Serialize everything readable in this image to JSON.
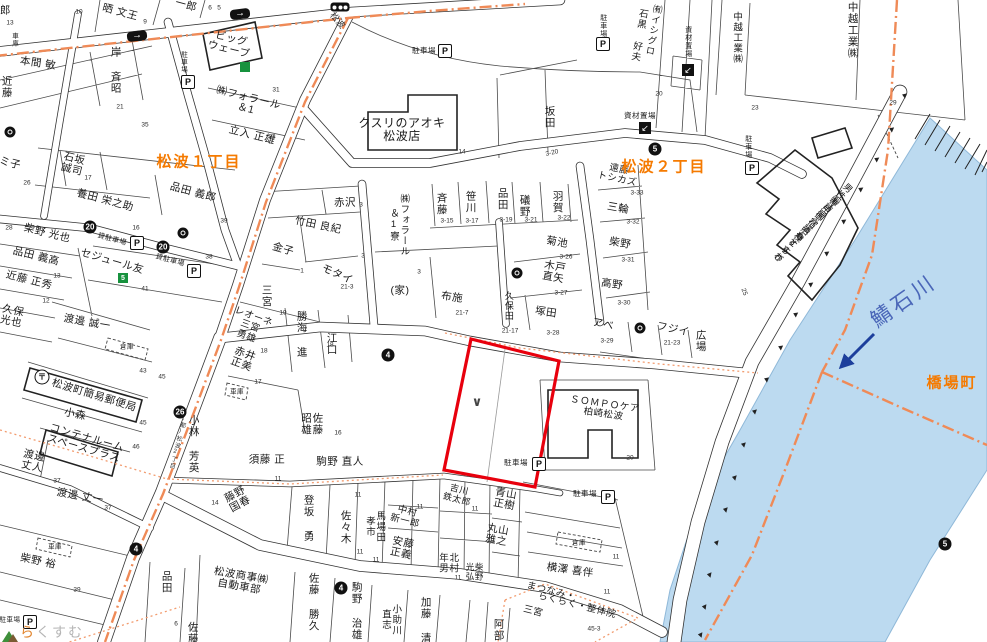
{
  "colors": {
    "boundary_orange": "#ef8a57",
    "river_fill": "#bcdaf0",
    "river_label_blue": "#4a66b8",
    "district_orange": "#f57a00",
    "highlight_red": "#e8000d",
    "flow_arrow_blue": "#1d3f9c"
  },
  "districts": [
    {
      "t": "松波１丁目",
      "x": 199,
      "y": 161
    },
    {
      "t": "松波２丁目",
      "x": 664,
      "y": 166
    },
    {
      "t": "橋場町",
      "x": 952,
      "y": 382
    }
  ],
  "river": {
    "name": "鯖石川",
    "x": 903,
    "y": 300
  },
  "road_names": [
    {
      "t": "松波",
      "x": 338,
      "y": 20,
      "r": 50,
      "s": 9
    },
    {
      "t": "(都)松波2丁目",
      "x": 177,
      "y": 442,
      "v": true,
      "r": 14,
      "s": 6
    }
  ],
  "watermark": {
    "t": "らくすむ",
    "x": 10,
    "y": 632
  },
  "highlight_parcel": {
    "mark": "∨",
    "x": 477,
    "y": 402
  },
  "labels": [
    {
      "t": "郎",
      "x": 4,
      "y": 10,
      "v": true
    },
    {
      "t": "晒 文王",
      "x": 120,
      "y": 13,
      "r": 15
    },
    {
      "t": "一郎",
      "x": 186,
      "y": 6,
      "r": 15
    },
    {
      "t": "本間 敏",
      "x": 38,
      "y": 64,
      "r": 8
    },
    {
      "t": "岸 斉昭",
      "x": 115,
      "y": 70,
      "v": true
    },
    {
      "t": "近藤",
      "x": 6,
      "y": 87,
      "v": true
    },
    {
      "t": "車庫",
      "x": 14,
      "y": 40,
      "v": true,
      "s": 6.5
    },
    {
      "t": "ビッグ\nウェーブ",
      "x": 230,
      "y": 45,
      "r": 14
    },
    {
      "t": "㈱フォラール\n＆1",
      "x": 247,
      "y": 104,
      "r": 14
    },
    {
      "t": "立入 正雄",
      "x": 252,
      "y": 136,
      "r": 14
    },
    {
      "t": "石坂\n誠司",
      "x": 73,
      "y": 165,
      "r": 14
    },
    {
      "t": "ミ子",
      "x": 10,
      "y": 164,
      "r": 14
    },
    {
      "t": "養田 栄之助",
      "x": 105,
      "y": 201,
      "r": 15
    },
    {
      "t": "品田 義郎",
      "x": 193,
      "y": 193,
      "r": 15
    },
    {
      "t": "柴野 光也",
      "x": 47,
      "y": 234,
      "r": 14
    },
    {
      "t": "品田 義高",
      "x": 36,
      "y": 257,
      "r": 14
    },
    {
      "t": "近藤 正秀",
      "x": 29,
      "y": 281,
      "r": 14
    },
    {
      "t": "セジュール友",
      "x": 112,
      "y": 262,
      "r": 16
    },
    {
      "t": "貸駐車場",
      "x": 112,
      "y": 240,
      "r": 15,
      "s": 7
    },
    {
      "t": "貸駐車場",
      "x": 170,
      "y": 261,
      "r": 15,
      "s": 7
    },
    {
      "t": "渡邊 誠一",
      "x": 87,
      "y": 323,
      "r": 10
    },
    {
      "t": "倉庫",
      "x": 127,
      "y": 347,
      "s": 6.5
    },
    {
      "t": "松波町簡易郵便局",
      "x": 94,
      "y": 396,
      "r": 17
    },
    {
      "t": "小森",
      "x": 75,
      "y": 415,
      "r": 12
    },
    {
      "t": "コンテナルーム\nスペースプラス",
      "x": 85,
      "y": 444,
      "r": 16
    },
    {
      "t": "渡邊\n丈人",
      "x": 33,
      "y": 462,
      "r": 12
    },
    {
      "t": "小林 芳英",
      "x": 193,
      "y": 444,
      "v": true
    },
    {
      "t": "赤井\n正美",
      "x": 243,
      "y": 360,
      "r": 20
    },
    {
      "t": "レオーネ\n三宮\n勇雄",
      "x": 250,
      "y": 327,
      "r": 20,
      "s": 9.5
    },
    {
      "t": "勝海 進",
      "x": 301,
      "y": 334,
      "v": true
    },
    {
      "t": "江口",
      "x": 331,
      "y": 344,
      "v": true
    },
    {
      "t": "佐藤\n昭雄",
      "x": 311,
      "y": 424,
      "v": true
    },
    {
      "t": "須藤 正",
      "x": 267,
      "y": 460
    },
    {
      "t": "駒野 直人",
      "x": 340,
      "y": 462
    },
    {
      "t": "車庫",
      "x": 237,
      "y": 392,
      "s": 6.5
    },
    {
      "t": "久保\n光也",
      "x": 12,
      "y": 317,
      "r": 12
    },
    {
      "t": "渡邊 丈一",
      "x": 80,
      "y": 497,
      "r": 10
    },
    {
      "t": "柴野 裕",
      "x": 38,
      "y": 562,
      "r": 12
    },
    {
      "t": "車庫",
      "x": 55,
      "y": 547,
      "s": 6.5
    },
    {
      "t": "品田",
      "x": 166,
      "y": 582,
      "v": true
    },
    {
      "t": "佐藤",
      "x": 192,
      "y": 633,
      "v": true
    },
    {
      "t": "藤野\n国春",
      "x": 238,
      "y": 500,
      "r": -28
    },
    {
      "t": "松波商事㈱\n自動車部",
      "x": 240,
      "y": 582,
      "r": 10
    },
    {
      "t": "佐藤 勝久",
      "x": 313,
      "y": 602,
      "v": true
    },
    {
      "t": "駒野 治雄",
      "x": 356,
      "y": 611,
      "v": true
    },
    {
      "t": "小助川\n直志",
      "x": 390,
      "y": 620,
      "v": true,
      "s": 9.5
    },
    {
      "t": "加藤 清",
      "x": 425,
      "y": 620,
      "v": true
    },
    {
      "t": "登坂 勇",
      "x": 308,
      "y": 518,
      "v": true
    },
    {
      "t": "佐々木",
      "x": 345,
      "y": 527,
      "v": true
    },
    {
      "t": "馬場田\n孝市",
      "x": 374,
      "y": 527,
      "v": true,
      "s": 9.5
    },
    {
      "t": "中村\n新一郎",
      "x": 406,
      "y": 517,
      "r": 14,
      "s": 9.5
    },
    {
      "t": "安藤\n正義",
      "x": 402,
      "y": 549,
      "r": 12
    },
    {
      "t": "吉川\n鉄太郎",
      "x": 458,
      "y": 495,
      "r": 14,
      "s": 9
    },
    {
      "t": "青山\n正樹",
      "x": 505,
      "y": 500,
      "r": 10
    },
    {
      "t": "丸山\n雅之",
      "x": 497,
      "y": 536,
      "r": 10
    },
    {
      "t": "柴野\n光弘",
      "x": 474,
      "y": 572,
      "v": true,
      "s": 8.5
    },
    {
      "t": "北村\n年男",
      "x": 447,
      "y": 563,
      "v": true,
      "s": 9.5
    },
    {
      "t": "阿部",
      "x": 498,
      "y": 630,
      "v": true
    },
    {
      "t": "横澤 喜伴",
      "x": 570,
      "y": 571,
      "r": 8
    },
    {
      "t": "倉庫",
      "x": 579,
      "y": 543,
      "s": 6.5
    },
    {
      "t": "まつなみ・",
      "x": 551,
      "y": 592,
      "r": 14,
      "s": 9.5
    },
    {
      "t": "らくらく・整体院",
      "x": 577,
      "y": 606,
      "r": 14,
      "s": 9.5
    },
    {
      "t": "三宮",
      "x": 533,
      "y": 612,
      "r": 14,
      "s": 9.5
    },
    {
      "t": "駐車場",
      "x": 516,
      "y": 463,
      "s": 7.5
    },
    {
      "t": "駐車場",
      "x": 585,
      "y": 494,
      "s": 7.5
    },
    {
      "t": "ＳＯＭＰＯケア\n柏崎松波",
      "x": 604,
      "y": 410,
      "r": 8,
      "s": 9.5
    },
    {
      "t": "赤沢",
      "x": 345,
      "y": 203
    },
    {
      "t": "竹田 良紀",
      "x": 318,
      "y": 226,
      "r": 12
    },
    {
      "t": "金子",
      "x": 283,
      "y": 250,
      "r": 16
    },
    {
      "t": "モタイ",
      "x": 337,
      "y": 275,
      "r": 24
    },
    {
      "t": "三宮",
      "x": 266,
      "y": 296,
      "v": true
    },
    {
      "t": "㈱フォラール\n＆1寮",
      "x": 398,
      "y": 225,
      "v": true,
      "s": 9.5
    },
    {
      "t": "斉藤",
      "x": 441,
      "y": 204,
      "v": true
    },
    {
      "t": "笹川",
      "x": 470,
      "y": 202,
      "v": true
    },
    {
      "t": "品田",
      "x": 502,
      "y": 199,
      "v": true
    },
    {
      "t": "礒野",
      "x": 524,
      "y": 206,
      "v": true
    },
    {
      "t": "羽賀",
      "x": 557,
      "y": 202,
      "v": true
    },
    {
      "t": "(家)",
      "x": 400,
      "y": 291
    },
    {
      "t": "布施",
      "x": 452,
      "y": 298,
      "r": 8
    },
    {
      "t": "菊池",
      "x": 557,
      "y": 243,
      "r": 10
    },
    {
      "t": "木戸\n直矢",
      "x": 554,
      "y": 273,
      "r": 10
    },
    {
      "t": "久保田",
      "x": 508,
      "y": 306,
      "v": true,
      "s": 9
    },
    {
      "t": "塚田",
      "x": 546,
      "y": 313,
      "r": 8
    },
    {
      "t": "アベ",
      "x": 603,
      "y": 325,
      "r": 12
    },
    {
      "t": "フジイ",
      "x": 673,
      "y": 330,
      "r": 12
    },
    {
      "t": "広場",
      "x": 700,
      "y": 341,
      "v": true
    },
    {
      "t": "遠藤\nトシカズ",
      "x": 618,
      "y": 175,
      "r": 12,
      "s": 9.5
    },
    {
      "t": "三輪",
      "x": 618,
      "y": 209,
      "r": 10
    },
    {
      "t": "柴野",
      "x": 620,
      "y": 244,
      "r": 10
    },
    {
      "t": "高野",
      "x": 612,
      "y": 285,
      "r": 8
    },
    {
      "t": "クスリのアオキ\n松波店",
      "x": 402,
      "y": 130,
      "s": 12
    },
    {
      "t": "駐車場",
      "x": 424,
      "y": 51,
      "s": 7.5
    },
    {
      "t": "駐車場",
      "x": 603,
      "y": 26,
      "v": true,
      "s": 7
    },
    {
      "t": "駐車場",
      "x": 183,
      "y": 62,
      "v": true,
      "s": 6.5
    },
    {
      "t": "駐車場",
      "x": 748,
      "y": 147,
      "v": true,
      "s": 7
    },
    {
      "t": "駐車場",
      "x": 10,
      "y": 620,
      "s": 6.5
    },
    {
      "t": "坂田",
      "x": 549,
      "y": 117,
      "v": true
    },
    {
      "t": "㈲イシグロ",
      "x": 652,
      "y": 30,
      "v": true,
      "r": 10,
      "s": 9.5
    },
    {
      "t": "石黒 好夫",
      "x": 638,
      "y": 35,
      "v": true,
      "r": 10,
      "s": 9.5
    },
    {
      "t": "中越工業㈱",
      "x": 736,
      "y": 38,
      "v": true,
      "s": 9.5
    },
    {
      "t": "中越工業㈱",
      "x": 852,
      "y": 30,
      "v": true
    },
    {
      "t": "資材置場",
      "x": 640,
      "y": 116,
      "s": 7.5
    },
    {
      "t": "資材置場",
      "x": 688,
      "y": 42,
      "v": true,
      "s": 7
    },
    {
      "t": "男性専用御宿泊棟",
      "x": 822,
      "y": 212,
      "v": true,
      "r": 45,
      "s": 9
    },
    {
      "t": "㈲訪問介護もとすわ",
      "x": 806,
      "y": 228,
      "v": true,
      "r": 45,
      "s": 9
    },
    {
      "t": "やすらぎ",
      "x": 788,
      "y": 246,
      "v": true,
      "r": 45,
      "s": 9
    }
  ],
  "numbers": [
    {
      "t": "10",
      "x": 79,
      "y": 12
    },
    {
      "t": "13",
      "x": 10,
      "y": 23
    },
    {
      "t": "9",
      "x": 145,
      "y": 22
    },
    {
      "t": "6",
      "x": 210,
      "y": 8
    },
    {
      "t": "5",
      "x": 219,
      "y": 8
    },
    {
      "t": "21",
      "x": 120,
      "y": 107
    },
    {
      "t": "35",
      "x": 145,
      "y": 125
    },
    {
      "t": "31",
      "x": 276,
      "y": 90
    },
    {
      "t": "33",
      "x": 272,
      "y": 137
    },
    {
      "t": "14",
      "x": 462,
      "y": 152
    },
    {
      "t": "20",
      "x": 659,
      "y": 94
    },
    {
      "t": "23",
      "x": 755,
      "y": 108
    },
    {
      "t": "29",
      "x": 893,
      "y": 103
    },
    {
      "t": "3-20",
      "x": 552,
      "y": 153,
      "r": -12
    },
    {
      "t": "17",
      "x": 88,
      "y": 178
    },
    {
      "t": "26",
      "x": 27,
      "y": 183
    },
    {
      "t": "16",
      "x": 136,
      "y": 228
    },
    {
      "t": "39",
      "x": 224,
      "y": 221
    },
    {
      "t": "28",
      "x": 9,
      "y": 228
    },
    {
      "t": "38",
      "x": 209,
      "y": 257
    },
    {
      "t": "13",
      "x": 57,
      "y": 276
    },
    {
      "t": "12",
      "x": 46,
      "y": 301
    },
    {
      "t": "41",
      "x": 145,
      "y": 289
    },
    {
      "t": "3",
      "x": 361,
      "y": 205
    },
    {
      "t": "3-15",
      "x": 447,
      "y": 221
    },
    {
      "t": "3-17",
      "x": 472,
      "y": 221
    },
    {
      "t": "3-19",
      "x": 506,
      "y": 220
    },
    {
      "t": "3-21",
      "x": 531,
      "y": 220
    },
    {
      "t": "3-22",
      "x": 564,
      "y": 218
    },
    {
      "t": "21-3",
      "x": 347,
      "y": 287
    },
    {
      "t": "3",
      "x": 363,
      "y": 256
    },
    {
      "t": "3",
      "x": 419,
      "y": 272
    },
    {
      "t": "21-7",
      "x": 462,
      "y": 313
    },
    {
      "t": "1",
      "x": 302,
      "y": 271
    },
    {
      "t": "19",
      "x": 283,
      "y": 313
    },
    {
      "t": "18",
      "x": 264,
      "y": 351
    },
    {
      "t": "17",
      "x": 258,
      "y": 382
    },
    {
      "t": "18",
      "x": 330,
      "y": 345
    },
    {
      "t": "16",
      "x": 338,
      "y": 433
    },
    {
      "t": "3-33",
      "x": 637,
      "y": 193
    },
    {
      "t": "3-32",
      "x": 633,
      "y": 222
    },
    {
      "t": "3-31",
      "x": 628,
      "y": 260
    },
    {
      "t": "3-30",
      "x": 624,
      "y": 303
    },
    {
      "t": "3-26",
      "x": 566,
      "y": 257
    },
    {
      "t": "3-27",
      "x": 561,
      "y": 293
    },
    {
      "t": "25",
      "x": 744,
      "y": 292,
      "r": 70
    },
    {
      "t": "21-23",
      "x": 672,
      "y": 343
    },
    {
      "t": "3-29",
      "x": 607,
      "y": 341
    },
    {
      "t": "3-28",
      "x": 553,
      "y": 333
    },
    {
      "t": "21-17",
      "x": 510,
      "y": 331
    },
    {
      "t": "20",
      "x": 630,
      "y": 458
    },
    {
      "t": "43",
      "x": 143,
      "y": 371
    },
    {
      "t": "45",
      "x": 162,
      "y": 377
    },
    {
      "t": "45",
      "x": 143,
      "y": 423
    },
    {
      "t": "46",
      "x": 136,
      "y": 447
    },
    {
      "t": "37",
      "x": 57,
      "y": 481
    },
    {
      "t": "37",
      "x": 108,
      "y": 508
    },
    {
      "t": "39",
      "x": 77,
      "y": 590
    },
    {
      "t": "14",
      "x": 215,
      "y": 503
    },
    {
      "t": "6",
      "x": 176,
      "y": 624
    },
    {
      "t": "11",
      "x": 278,
      "y": 479
    },
    {
      "t": "11",
      "x": 358,
      "y": 495
    },
    {
      "t": "11",
      "x": 420,
      "y": 507
    },
    {
      "t": "11",
      "x": 475,
      "y": 509
    },
    {
      "t": "11",
      "x": 360,
      "y": 552
    },
    {
      "t": "11",
      "x": 376,
      "y": 560
    },
    {
      "t": "11",
      "x": 458,
      "y": 578
    },
    {
      "t": "45-3",
      "x": 594,
      "y": 629
    },
    {
      "t": "11",
      "x": 616,
      "y": 557
    },
    {
      "t": "11",
      "x": 607,
      "y": 592
    }
  ],
  "badges": [
    {
      "n": "20",
      "x": 90,
      "y": 227
    },
    {
      "n": "20",
      "x": 163,
      "y": 247
    },
    {
      "n": "26",
      "x": 180,
      "y": 412
    },
    {
      "n": "4",
      "x": 388,
      "y": 355
    },
    {
      "n": "4",
      "x": 136,
      "y": 549
    },
    {
      "n": "4",
      "x": 341,
      "y": 588
    },
    {
      "n": "5",
      "x": 655,
      "y": 149
    },
    {
      "n": "5",
      "x": 945,
      "y": 544
    }
  ],
  "green_signs": [
    {
      "t": "",
      "x": 245,
      "y": 67
    },
    {
      "t": "5",
      "x": 123,
      "y": 278
    }
  ],
  "company_marks": [
    {
      "x": 10,
      "y": 132
    },
    {
      "x": 183,
      "y": 233
    },
    {
      "x": 517,
      "y": 273
    },
    {
      "x": 640,
      "y": 328
    }
  ],
  "parking_icons": [
    {
      "x": 188,
      "y": 82
    },
    {
      "x": 445,
      "y": 51
    },
    {
      "x": 603,
      "y": 44
    },
    {
      "x": 137,
      "y": 243
    },
    {
      "x": 194,
      "y": 271
    },
    {
      "x": 539,
      "y": 464
    },
    {
      "x": 608,
      "y": 497
    },
    {
      "x": 30,
      "y": 622
    },
    {
      "x": 752,
      "y": 168
    }
  ],
  "material_icons": [
    {
      "x": 645,
      "y": 128
    },
    {
      "x": 688,
      "y": 70
    }
  ],
  "post_office_icon": {
    "x": 42,
    "y": 377,
    "glyph": "〒"
  },
  "traffic_signal_icon": {
    "x": 340,
    "y": 7
  },
  "oneway_arrows": [
    {
      "x": 137,
      "y": 36,
      "r": -7
    },
    {
      "x": 240,
      "y": 14,
      "r": -7
    }
  ]
}
